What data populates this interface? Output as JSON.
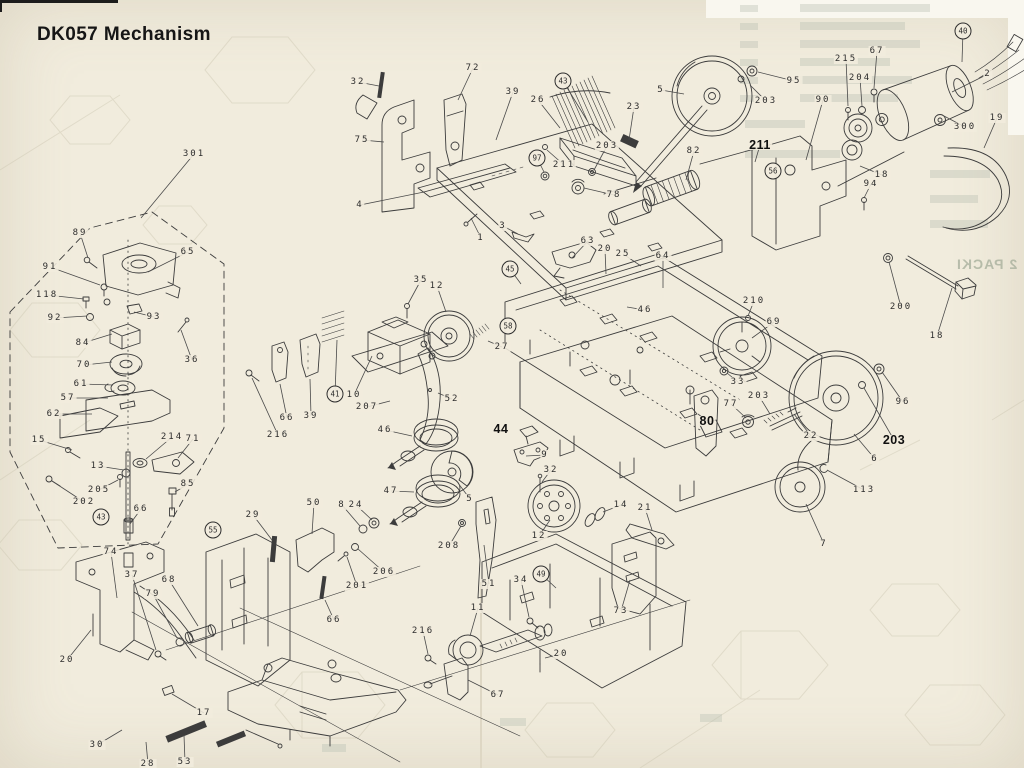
{
  "page": {
    "title": "DK057 Mechanism",
    "paper_color": "#f1ecdd",
    "ink_color": "#3c3c3c",
    "ghost_color": "#b9bfb2"
  },
  "ghost": {
    "packing_label": "2 PACKI"
  },
  "labels": [
    {
      "t": "301",
      "x": 194,
      "y": 154,
      "lx": 141,
      "ly": 218
    },
    {
      "t": "89",
      "x": 80,
      "y": 233,
      "lx": 88,
      "ly": 258
    },
    {
      "t": "65",
      "x": 188,
      "y": 252,
      "lx": 148,
      "ly": 272
    },
    {
      "t": "91",
      "x": 50,
      "y": 267,
      "lx": 100,
      "ly": 285
    },
    {
      "t": "118",
      "x": 47,
      "y": 295,
      "lx": 84,
      "ly": 299
    },
    {
      "t": "92",
      "x": 55,
      "y": 318,
      "lx": 87,
      "ly": 316
    },
    {
      "t": "93",
      "x": 154,
      "y": 317,
      "lx": 134,
      "ly": 312
    },
    {
      "t": "36",
      "x": 192,
      "y": 360,
      "lx": 181,
      "ly": 330
    },
    {
      "t": "84",
      "x": 83,
      "y": 343,
      "lx": 112,
      "ly": 334
    },
    {
      "t": "70",
      "x": 84,
      "y": 365,
      "lx": 112,
      "ly": 362
    },
    {
      "t": "61",
      "x": 81,
      "y": 384,
      "lx": 113,
      "ly": 385
    },
    {
      "t": "57",
      "x": 68,
      "y": 398,
      "lx": 108,
      "ly": 398
    },
    {
      "t": "62",
      "x": 54,
      "y": 414,
      "lx": 92,
      "ly": 414
    },
    {
      "t": "15",
      "x": 39,
      "y": 440,
      "lx": 72,
      "ly": 450
    },
    {
      "t": "214",
      "x": 172,
      "y": 437,
      "lx": 146,
      "ly": 459
    },
    {
      "t": "71",
      "x": 193,
      "y": 439,
      "lx": 178,
      "ly": 458
    },
    {
      "t": "13",
      "x": 98,
      "y": 466,
      "lx": 124,
      "ly": 470
    },
    {
      "t": "205",
      "x": 99,
      "y": 490,
      "lx": 118,
      "ly": 480
    },
    {
      "t": "202",
      "x": 84,
      "y": 502,
      "lx": 52,
      "ly": 481
    },
    {
      "t": "43",
      "x": 101,
      "y": 517,
      "c": 1
    },
    {
      "t": "66",
      "x": 141,
      "y": 509,
      "lx": 130,
      "ly": 524
    },
    {
      "t": "85",
      "x": 188,
      "y": 484,
      "lx": 175,
      "ly": 492
    },
    {
      "t": "55",
      "x": 213,
      "y": 530,
      "c": 1
    },
    {
      "t": "32",
      "x": 358,
      "y": 82,
      "lx": 379,
      "ly": 86
    },
    {
      "t": "72",
      "x": 473,
      "y": 68,
      "lx": 458,
      "ly": 100
    },
    {
      "t": "75",
      "x": 362,
      "y": 140,
      "lx": 384,
      "ly": 142
    },
    {
      "t": "4",
      "x": 360,
      "y": 205,
      "lx": 424,
      "ly": 192
    },
    {
      "t": "39",
      "x": 513,
      "y": 92,
      "lx": 496,
      "ly": 140
    },
    {
      "t": "26",
      "x": 538,
      "y": 100,
      "lx": 560,
      "ly": 128
    },
    {
      "t": "43",
      "x": 563,
      "y": 81,
      "c": 1,
      "lx": 588,
      "ly": 122
    },
    {
      "t": "23",
      "x": 634,
      "y": 107,
      "lx": 629,
      "ly": 140
    },
    {
      "t": "203",
      "x": 607,
      "y": 146,
      "lx": 594,
      "ly": 170
    },
    {
      "t": "97",
      "x": 537,
      "y": 158,
      "c": 1,
      "lx": 544,
      "ly": 172
    },
    {
      "t": "211",
      "x": 564,
      "y": 165,
      "lx": 547,
      "ly": 150
    },
    {
      "t": "78",
      "x": 614,
      "y": 195,
      "lx": 584,
      "ly": 188
    },
    {
      "t": "1",
      "x": 481,
      "y": 238,
      "lx": 471,
      "ly": 218
    },
    {
      "t": "3",
      "x": 503,
      "y": 226,
      "lx": 518,
      "ly": 234
    },
    {
      "t": "63",
      "x": 588,
      "y": 241,
      "lx": 572,
      "ly": 258
    },
    {
      "t": "5",
      "x": 661,
      "y": 90,
      "lx": 684,
      "ly": 94
    },
    {
      "t": "95",
      "x": 794,
      "y": 81,
      "lx": 758,
      "ly": 72
    },
    {
      "t": "203",
      "x": 766,
      "y": 101,
      "lx": 750,
      "ly": 85
    },
    {
      "t": "90",
      "x": 823,
      "y": 100,
      "lx": 806,
      "ly": 160
    },
    {
      "t": "215",
      "x": 846,
      "y": 59,
      "lx": 848,
      "ly": 106
    },
    {
      "t": "67",
      "x": 877,
      "y": 51,
      "lx": 874,
      "ly": 88
    },
    {
      "t": "204",
      "x": 860,
      "y": 78,
      "lx": 862,
      "ly": 106
    },
    {
      "t": "2",
      "x": 988,
      "y": 74,
      "lx": 952,
      "ly": 92
    },
    {
      "t": "300",
      "x": 965,
      "y": 127,
      "lx": 944,
      "ly": 116
    },
    {
      "t": "19",
      "x": 997,
      "y": 118,
      "lx": 984,
      "ly": 148
    },
    {
      "t": "82",
      "x": 694,
      "y": 151,
      "lx": 686,
      "ly": 180
    },
    {
      "t": "211",
      "x": 760,
      "y": 145,
      "b": 1,
      "lx": 755,
      "ly": 162
    },
    {
      "t": "56",
      "x": 773,
      "y": 171,
      "c": 1
    },
    {
      "t": "40",
      "x": 963,
      "y": 31,
      "c": 1,
      "lx": 962,
      "ly": 62
    },
    {
      "t": "94",
      "x": 871,
      "y": 184,
      "lx": 864,
      "ly": 198
    },
    {
      "t": "18",
      "x": 882,
      "y": 175,
      "lx": 860,
      "ly": 166
    },
    {
      "t": "200",
      "x": 901,
      "y": 307,
      "lx": 889,
      "ly": 262
    },
    {
      "t": "18",
      "x": 937,
      "y": 336,
      "lx": 952,
      "ly": 288
    },
    {
      "t": "210",
      "x": 754,
      "y": 301,
      "lx": 748,
      "ly": 316
    },
    {
      "t": "69",
      "x": 774,
      "y": 322,
      "lx": 752,
      "ly": 338
    },
    {
      "t": "33",
      "x": 738,
      "y": 382,
      "lx": 727,
      "ly": 373
    },
    {
      "t": "96",
      "x": 903,
      "y": 402,
      "lx": 882,
      "ly": 372
    },
    {
      "t": "203",
      "x": 894,
      "y": 440,
      "b": 1,
      "lx": 864,
      "ly": 388
    },
    {
      "t": "22",
      "x": 811,
      "y": 436,
      "lx": 794,
      "ly": 414
    },
    {
      "t": "77",
      "x": 731,
      "y": 404,
      "lx": 746,
      "ly": 418
    },
    {
      "t": "203",
      "x": 759,
      "y": 396,
      "lx": 770,
      "ly": 414
    },
    {
      "t": "80",
      "x": 707,
      "y": 421,
      "b": 1,
      "lx": 698,
      "ly": 414
    },
    {
      "t": "6",
      "x": 875,
      "y": 459,
      "lx": 854,
      "ly": 434
    },
    {
      "t": "113",
      "x": 864,
      "y": 490,
      "lx": 827,
      "ly": 470
    },
    {
      "t": "7",
      "x": 824,
      "y": 544,
      "lx": 806,
      "ly": 504
    },
    {
      "t": "35",
      "x": 421,
      "y": 280,
      "lx": 408,
      "ly": 304
    },
    {
      "t": "12",
      "x": 437,
      "y": 286,
      "lx": 446,
      "ly": 312
    },
    {
      "t": "27",
      "x": 502,
      "y": 347,
      "lx": 488,
      "ly": 341
    },
    {
      "t": "45",
      "x": 510,
      "y": 269,
      "c": 1,
      "lx": 521,
      "ly": 284
    },
    {
      "t": "58",
      "x": 508,
      "y": 326,
      "c": 1
    },
    {
      "t": "41",
      "x": 335,
      "y": 394,
      "c": 1,
      "lx": 337,
      "ly": 340
    },
    {
      "t": "10",
      "x": 354,
      "y": 395,
      "lx": 372,
      "ly": 356
    },
    {
      "t": "207",
      "x": 367,
      "y": 407,
      "lx": 390,
      "ly": 401
    },
    {
      "t": "216",
      "x": 278,
      "y": 435,
      "lx": 252,
      "ly": 378
    },
    {
      "t": "66",
      "x": 287,
      "y": 418,
      "lx": 280,
      "ly": 384
    },
    {
      "t": "39",
      "x": 311,
      "y": 416,
      "lx": 310,
      "ly": 379
    },
    {
      "t": "52",
      "x": 452,
      "y": 399,
      "lx": 438,
      "ly": 393
    },
    {
      "t": "46",
      "x": 385,
      "y": 430,
      "lx": 412,
      "ly": 436
    },
    {
      "t": "47",
      "x": 391,
      "y": 491,
      "lx": 414,
      "ly": 492
    },
    {
      "t": "8",
      "x": 342,
      "y": 505,
      "lx": 360,
      "ly": 526
    },
    {
      "t": "24",
      "x": 356,
      "y": 505,
      "lx": 372,
      "ly": 520
    },
    {
      "t": "206",
      "x": 384,
      "y": 572,
      "lx": 358,
      "ly": 549
    },
    {
      "t": "201",
      "x": 357,
      "y": 586,
      "lx": 347,
      "ly": 557
    },
    {
      "t": "208",
      "x": 449,
      "y": 546,
      "lx": 461,
      "ly": 526
    },
    {
      "t": "5",
      "x": 470,
      "y": 499,
      "lx": 458,
      "ly": 483
    },
    {
      "t": "44",
      "x": 501,
      "y": 429,
      "b": 1
    },
    {
      "t": "9",
      "x": 545,
      "y": 455,
      "lx": 526,
      "ly": 456
    },
    {
      "t": "32",
      "x": 551,
      "y": 470,
      "lx": 542,
      "ly": 482
    },
    {
      "t": "12",
      "x": 539,
      "y": 536,
      "lx": 550,
      "ly": 520
    },
    {
      "t": "14",
      "x": 621,
      "y": 505,
      "lx": 603,
      "ly": 512
    },
    {
      "t": "21",
      "x": 645,
      "y": 508,
      "lx": 652,
      "ly": 530
    },
    {
      "t": "51",
      "x": 489,
      "y": 584,
      "lx": 484,
      "ly": 545
    },
    {
      "t": "34",
      "x": 521,
      "y": 580,
      "lx": 529,
      "ly": 617
    },
    {
      "t": "49",
      "x": 541,
      "y": 574,
      "c": 1,
      "lx": 556,
      "ly": 588
    },
    {
      "t": "73",
      "x": 621,
      "y": 611,
      "lx": 630,
      "ly": 580
    },
    {
      "t": "11",
      "x": 478,
      "y": 608,
      "lx": 470,
      "ly": 636
    },
    {
      "t": "216",
      "x": 423,
      "y": 631,
      "lx": 428,
      "ly": 654
    },
    {
      "t": "20",
      "x": 561,
      "y": 654,
      "lx": 545,
      "ly": 658
    },
    {
      "t": "67",
      "x": 498,
      "y": 695,
      "lx": 468,
      "ly": 680
    },
    {
      "t": "20",
      "x": 605,
      "y": 249,
      "lx": 606,
      "ly": 274
    },
    {
      "t": "25",
      "x": 623,
      "y": 254,
      "lx": 641,
      "ly": 266
    },
    {
      "t": "64",
      "x": 663,
      "y": 256,
      "lx": 663,
      "ly": 288
    },
    {
      "t": "46",
      "x": 645,
      "y": 310,
      "lx": 627,
      "ly": 307
    },
    {
      "t": "74",
      "x": 111,
      "y": 552,
      "lx": 117,
      "ly": 598
    },
    {
      "t": "37",
      "x": 132,
      "y": 575,
      "lx": 156,
      "ly": 650
    },
    {
      "t": "79",
      "x": 153,
      "y": 594,
      "lx": 177,
      "ly": 638
    },
    {
      "t": "68",
      "x": 169,
      "y": 580,
      "lx": 198,
      "ly": 626
    },
    {
      "t": "20",
      "x": 67,
      "y": 660,
      "lx": 91,
      "ly": 630
    },
    {
      "t": "30",
      "x": 97,
      "y": 745,
      "lx": 122,
      "ly": 730
    },
    {
      "t": "28",
      "x": 148,
      "y": 764,
      "lx": 146,
      "ly": 742
    },
    {
      "t": "53",
      "x": 185,
      "y": 762,
      "lx": 184,
      "ly": 735
    },
    {
      "t": "17",
      "x": 204,
      "y": 713,
      "lx": 172,
      "ly": 694
    },
    {
      "t": "29",
      "x": 253,
      "y": 515,
      "lx": 272,
      "ly": 540
    },
    {
      "t": "50",
      "x": 314,
      "y": 503,
      "lx": 312,
      "ly": 534
    },
    {
      "t": "66",
      "x": 334,
      "y": 620,
      "lx": 325,
      "ly": 600
    }
  ]
}
